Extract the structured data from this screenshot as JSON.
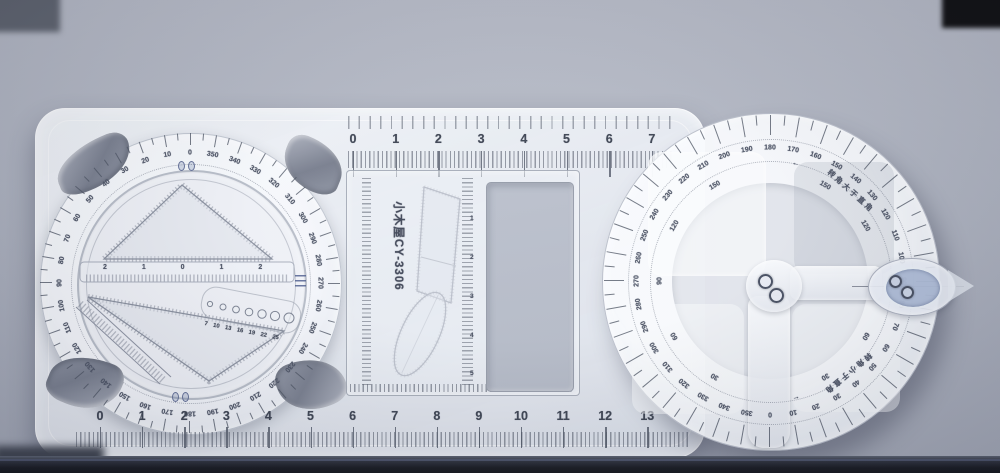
{
  "photo": {
    "subject": "multifunctional geometric drawing ruler on desk",
    "background_color": "#a9aebb",
    "bottom_band_color": "#15171e",
    "top_right_patch_color": "#0a0a0c",
    "top_left_patch_color": "#5c616c",
    "cursor_tint_color": "#7d94be"
  },
  "tool": {
    "brand_text": "小木屋",
    "model_text": "CY-3306",
    "top_ruler_numbers": [
      "0",
      "1",
      "2",
      "3",
      "4",
      "5",
      "6",
      "7"
    ],
    "bottom_ruler_numbers": [
      "0",
      "1",
      "2",
      "3",
      "4",
      "5",
      "6",
      "7",
      "8",
      "9",
      "10",
      "11",
      "12",
      "13"
    ],
    "center_panel": {
      "vertical_ruler_numbers": [
        "1",
        "2",
        "3",
        "4",
        "5"
      ]
    },
    "left_dial": {
      "degree_labels": [
        "0",
        "350",
        "340",
        "330",
        "320",
        "310",
        "300",
        "290",
        "280",
        "270",
        "260",
        "250",
        "240",
        "230",
        "220",
        "210",
        "200",
        "190",
        "180",
        "170",
        "160",
        "150",
        "140",
        "130",
        "120",
        "110",
        "100",
        "90",
        "80",
        "70",
        "60",
        "50",
        "40",
        "30",
        "20",
        "10"
      ],
      "center_ruler_labels": "2 1 0 1 2",
      "circle_template_sizes": "7 10 13 16 19 22 25"
    },
    "right_protractor": {
      "outer_degree_labels": [
        "180",
        "170",
        "160",
        "150",
        "140",
        "130",
        "120",
        "110",
        "100",
        "90",
        "80",
        "70",
        "60",
        "50",
        "40",
        "30",
        "20",
        "10",
        "0",
        "350",
        "340",
        "330",
        "320",
        "310",
        "300",
        "290",
        "280",
        "270",
        "260",
        "250",
        "240",
        "230",
        "220",
        "210",
        "200",
        "190"
      ],
      "inner_degree_labels": [
        {
          "a": -150,
          "t": "30"
        },
        {
          "a": -120,
          "t": "60"
        },
        {
          "a": -90,
          "t": "90"
        },
        {
          "a": -60,
          "t": "120"
        },
        {
          "a": -30,
          "t": "150"
        },
        {
          "a": 30,
          "t": "150"
        },
        {
          "a": 60,
          "t": "120"
        },
        {
          "a": 120,
          "t": "60"
        },
        {
          "a": 150,
          "t": "30"
        }
      ],
      "annotations": [
        {
          "a": 13,
          "t": "←"
        },
        {
          "a": 42,
          "t": "转角大于直角"
        },
        {
          "a": 140,
          "t": "转角小于直角"
        },
        {
          "a": 168,
          "t": "←"
        }
      ]
    }
  }
}
